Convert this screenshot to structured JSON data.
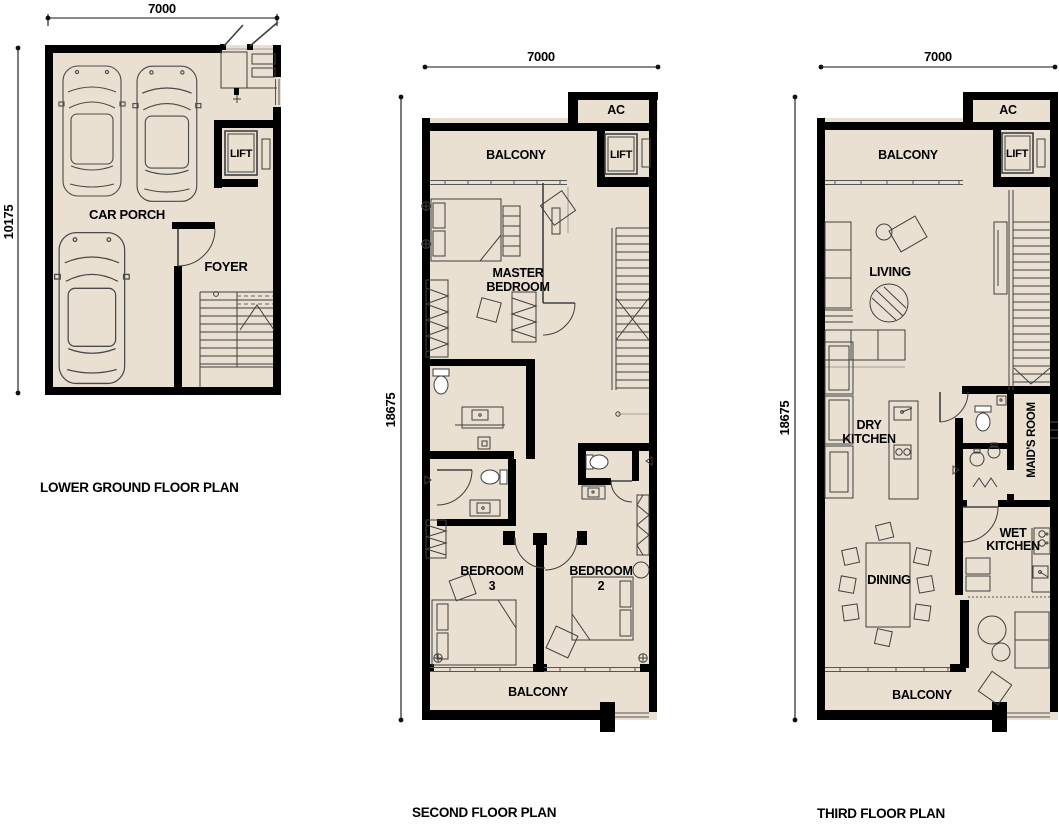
{
  "colors": {
    "floor": "#EAE0D2",
    "wall": "#000000",
    "background": "#FFFFFF"
  },
  "plan_lower_ground": {
    "title": "LOWER GROUND FLOOR PLAN",
    "dims": {
      "width": "7000",
      "height": "10175"
    },
    "labels": {
      "car_porch": "CAR PORCH",
      "foyer": "FOYER",
      "lift": "LIFT"
    }
  },
  "plan_second": {
    "title": "SECOND FLOOR PLAN",
    "dims": {
      "width": "7000",
      "height": "18675"
    },
    "labels": {
      "ac": "AC",
      "balcony_top": "BALCONY",
      "lift": "LIFT",
      "master_line1": "MASTER",
      "master_line2": "BEDROOM",
      "bedroom3_line1": "BEDROOM",
      "bedroom3_line2": "3",
      "bedroom2_line1": "BEDROOM",
      "bedroom2_line2": "2",
      "balcony_bottom": "BALCONY"
    }
  },
  "plan_third": {
    "title": "THIRD FLOOR PLAN",
    "dims": {
      "width": "7000",
      "height": "18675"
    },
    "labels": {
      "ac": "AC",
      "balcony_top": "BALCONY",
      "lift": "LIFT",
      "living": "LIVING",
      "dry_kitchen_line1": "DRY",
      "dry_kitchen_line2": "KITCHEN",
      "maids_room": "MAID'S ROOM",
      "wet_kitchen_line1": "WET",
      "wet_kitchen_line2": "KITCHEN",
      "dining": "DINING",
      "balcony_bottom": "BALCONY"
    }
  }
}
